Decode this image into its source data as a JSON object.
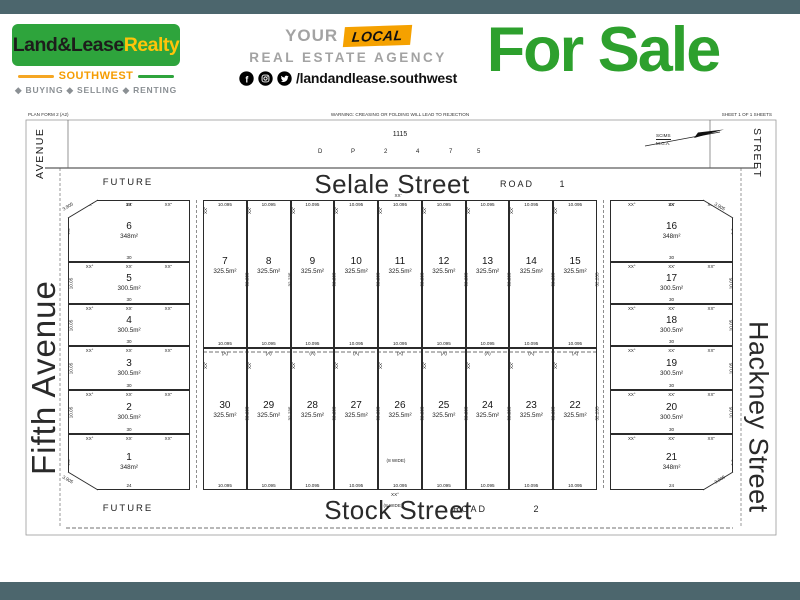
{
  "theme": {
    "bar": "#4c666d",
    "logo_green": "#2ea43c",
    "logo_yellow": "#ffc40a",
    "orange": "#f59c00",
    "agency_gray": "#a3a3a3",
    "local_bg": "#f5a100",
    "sale_green": "#2da02d"
  },
  "header": {
    "logo": {
      "name_black": "Land&Lease",
      "name_yellow": "Realty",
      "region": "SOUTHWEST",
      "tagline": "◆ BUYING ◆ SELLING ◆ RENTING"
    },
    "agency": {
      "your": "YOUR",
      "local": "LOCAL",
      "line2": "REAL ESTATE AGENCY",
      "handle": "/landandlease.southwest",
      "icons": [
        "facebook-icon",
        "instagram-icon",
        "twitter-icon"
      ]
    },
    "for_sale": "For Sale"
  },
  "plan": {
    "margin_left": "PLAN FORM 2 (A2)",
    "margin_center": "WARNING: CREASING OR FOLDING WILL LEAD TO REJECTION",
    "margin_right": "SHEET 1  OF 1 SHEETS",
    "plan_number": "1115",
    "dp_chars": [
      "D",
      "P",
      "2",
      "4",
      "7",
      "5"
    ],
    "compass": {
      "label_top": "SCIMS",
      "label_bottom": "M.G.A."
    },
    "top_road": {
      "future": "FUTURE",
      "name": "Selale Street",
      "road": "ROAD",
      "number": "1"
    },
    "bottom_road": {
      "future": "FUTURE",
      "name": "Stock Street",
      "road": "ROAD",
      "number": "2"
    },
    "side_labels": {
      "top_left": "AVENUE",
      "top_right": "STREET",
      "left": "Fifth Avenue",
      "right": "Hackney Street"
    },
    "dims": {
      "front": "10.095",
      "side": "32.235",
      "easement": "(A)",
      "wide": "(8 WIDE)",
      "deg": "XX°",
      "min": "XX'",
      "sec": "XX''",
      "chamfer": "3.905",
      "side_small": "10.05",
      "side_corner": "6.2"
    },
    "lots": {
      "left_column": [
        {
          "number": "6",
          "area": "348m²",
          "top": "24",
          "bottom": "30",
          "side": "6.2"
        },
        {
          "number": "5",
          "area": "300.5m²",
          "bottom": "30",
          "side": "10.05"
        },
        {
          "number": "4",
          "area": "300.5m²",
          "bottom": "30",
          "side": "10.05"
        },
        {
          "number": "3",
          "area": "300.5m²",
          "bottom": "30",
          "side": "10.05"
        },
        {
          "number": "2",
          "area": "300.5m²",
          "bottom": "30",
          "side": "10.05"
        },
        {
          "number": "1",
          "area": "348m²",
          "bottom": "24",
          "side": "6.2"
        }
      ],
      "right_column": [
        {
          "number": "16",
          "area": "348m²",
          "top": "24",
          "bottom": "30",
          "side": "6.2"
        },
        {
          "number": "17",
          "area": "300.5m²",
          "bottom": "30",
          "side": "10.05"
        },
        {
          "number": "18",
          "area": "300.5m²",
          "bottom": "30",
          "side": "10.05"
        },
        {
          "number": "19",
          "area": "300.5m²",
          "bottom": "30",
          "side": "10.05"
        },
        {
          "number": "20",
          "area": "300.5m²",
          "bottom": "30",
          "side": "10.05"
        },
        {
          "number": "21",
          "area": "348m²",
          "bottom": "24",
          "side": "6.2"
        }
      ],
      "top_row": [
        {
          "number": "7",
          "area": "325.5m²"
        },
        {
          "number": "8",
          "area": "325.5m²"
        },
        {
          "number": "9",
          "area": "325.5m²"
        },
        {
          "number": "10",
          "area": "325.5m²"
        },
        {
          "number": "11",
          "area": "325.5m²"
        },
        {
          "number": "12",
          "area": "325.5m²"
        },
        {
          "number": "13",
          "area": "325.5m²"
        },
        {
          "number": "14",
          "area": "325.5m²"
        },
        {
          "number": "15",
          "area": "325.5m²"
        }
      ],
      "bottom_row": [
        {
          "number": "30",
          "area": "325.5m²"
        },
        {
          "number": "29",
          "area": "325.5m²"
        },
        {
          "number": "28",
          "area": "325.5m²"
        },
        {
          "number": "27",
          "area": "325.5m²"
        },
        {
          "number": "26",
          "area": "325.5m²"
        },
        {
          "number": "25",
          "area": "325.5m²"
        },
        {
          "number": "24",
          "area": "325.5m²"
        },
        {
          "number": "23",
          "area": "325.5m²"
        },
        {
          "number": "22",
          "area": "325.5m²"
        }
      ]
    }
  }
}
